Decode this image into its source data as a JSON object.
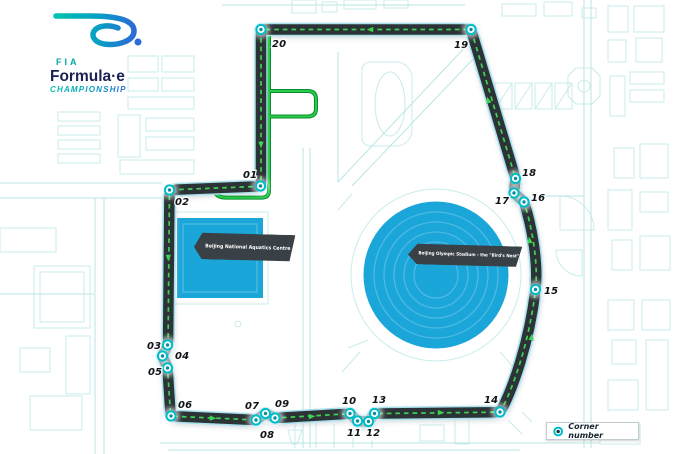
{
  "logo": {
    "fia": "FIA",
    "formula_e": "Formula·e",
    "championship": "CHAMPIONSHIP"
  },
  "venues": {
    "aquatics": {
      "label": "Beijing National Aquatics Centre"
    },
    "stadium": {
      "label": "Beijing Olympic Stadium - the \"Bird's Nest\""
    }
  },
  "legend": {
    "label": "Corner number"
  },
  "corners": [
    {
      "num": "01",
      "x": 260.5,
      "y": 186,
      "lx": 243,
      "ly": 178
    },
    {
      "num": "02",
      "x": 169.5,
      "y": 190,
      "lx": 175,
      "ly": 205
    },
    {
      "num": "03",
      "x": 167.5,
      "y": 345,
      "lx": 147,
      "ly": 349
    },
    {
      "num": "04",
      "x": 162.5,
      "y": 356,
      "lx": 175,
      "ly": 359
    },
    {
      "num": "05",
      "x": 167.5,
      "y": 368,
      "lx": 148,
      "ly": 375
    },
    {
      "num": "06",
      "x": 171,
      "y": 416,
      "lx": 178,
      "ly": 408
    },
    {
      "num": "07",
      "x": 256,
      "y": 420,
      "lx": 245,
      "ly": 409
    },
    {
      "num": "08",
      "x": 265.5,
      "y": 413.5,
      "lx": 260,
      "ly": 438
    },
    {
      "num": "09",
      "x": 275,
      "y": 418,
      "lx": 275,
      "ly": 407
    },
    {
      "num": "10",
      "x": 350,
      "y": 413.5,
      "lx": 342,
      "ly": 404
    },
    {
      "num": "11",
      "x": 357.5,
      "y": 421,
      "lx": 347,
      "ly": 436
    },
    {
      "num": "12",
      "x": 368.5,
      "y": 421.5,
      "lx": 366,
      "ly": 436
    },
    {
      "num": "13",
      "x": 374.5,
      "y": 413.5,
      "lx": 372,
      "ly": 403
    },
    {
      "num": "14",
      "x": 500,
      "y": 412,
      "lx": 484,
      "ly": 403
    },
    {
      "num": "15",
      "x": 535.5,
      "y": 289.5,
      "lx": 544,
      "ly": 294
    },
    {
      "num": "16",
      "x": 524,
      "y": 202,
      "lx": 531,
      "ly": 201
    },
    {
      "num": "17",
      "x": 514,
      "y": 193,
      "lx": 495,
      "ly": 204
    },
    {
      "num": "18",
      "x": 515.5,
      "y": 178.5,
      "lx": 522,
      "ly": 176
    },
    {
      "num": "19",
      "x": 471,
      "y": 29.5,
      "lx": 454,
      "ly": 48
    },
    {
      "num": "20",
      "x": 261,
      "y": 29.5,
      "lx": 272,
      "ly": 47
    }
  ],
  "colors": {
    "track_asphalt": "#2c3337",
    "track_edge": "#a8e0ec",
    "racing_line_dash": "#3fd151",
    "pit_lane_green": "#25d048",
    "pit_lane_edge": "#0e8a33",
    "marker_ring": "#00bec9",
    "marker_core": "#0b8fa0",
    "venue_fill": "#1ba6da",
    "map_lines": "#bfe7e7",
    "banner_bg": "#394046",
    "label_text": "#101417",
    "logo_teal": "#00a79b",
    "logo_navy": "#1b2153"
  }
}
